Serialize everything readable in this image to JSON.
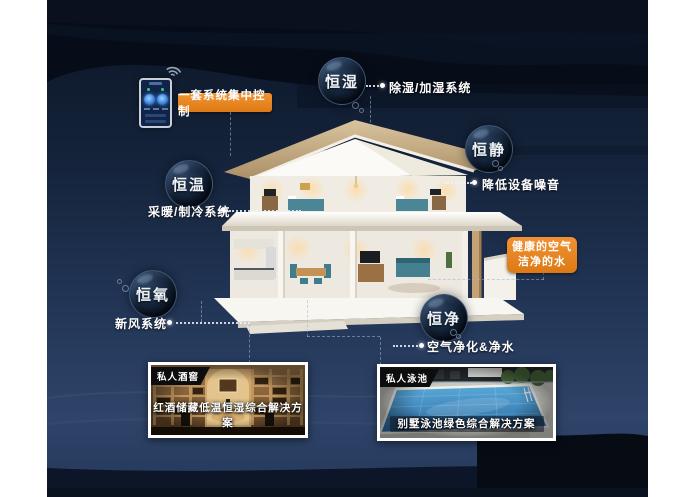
{
  "colors": {
    "accent_orange": "#E8871F",
    "panel_top": "#0b1424",
    "panel_bottom": "#2f4469",
    "bubble_text": "#eef3f8",
    "furniture_teal": "#44808f"
  },
  "icons": {
    "phone_wifi": "wifi-icon",
    "connector_dot": "dot-icon"
  },
  "control": {
    "banner_label": "一套系统集中控制"
  },
  "bubbles": [
    {
      "label": "恒湿",
      "desc": "除湿/加湿系统"
    },
    {
      "label": "恒静",
      "desc": "降低设备噪音"
    },
    {
      "label": "恒温",
      "desc": "采暖/制冷系统"
    },
    {
      "label": "恒氧",
      "desc": "新风系统"
    },
    {
      "label": "恒净",
      "desc": "空气净化&净水"
    }
  ],
  "callout": {
    "line1": "健康的空气",
    "line2": "洁净的水"
  },
  "cards": [
    {
      "tag": "私人酒窖",
      "caption": "红酒储藏低温恒湿综合解决方案"
    },
    {
      "tag": "私人泳池",
      "caption": "别墅泳池绿色综合解决方案"
    }
  ]
}
